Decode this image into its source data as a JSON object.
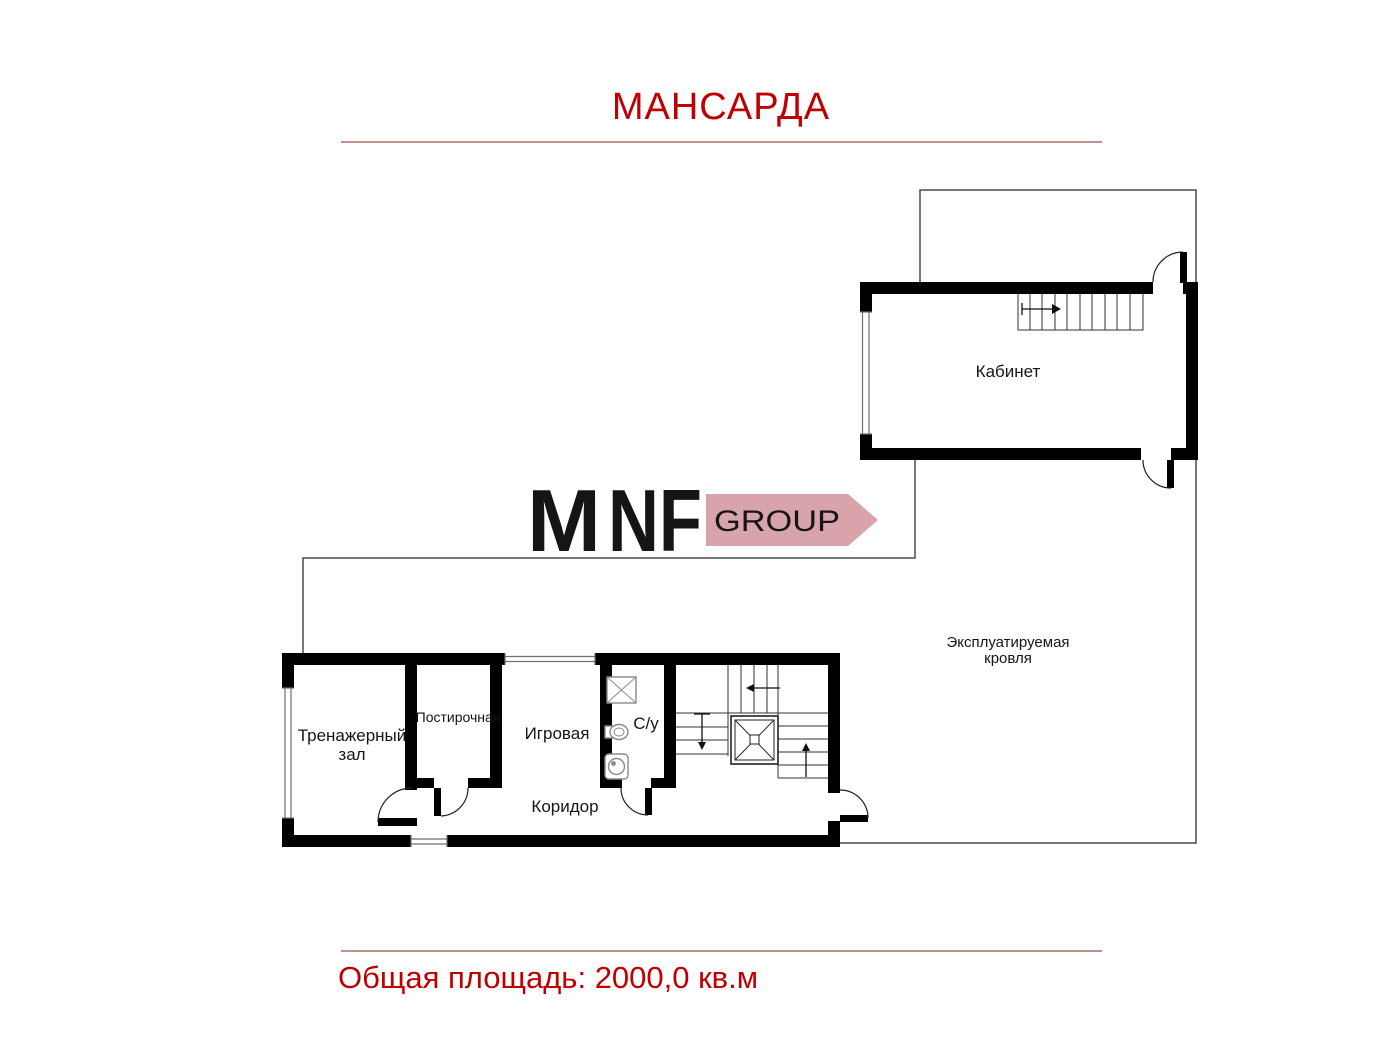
{
  "title": "МАНСАРДА",
  "footer": {
    "total_area": "Общая площадь: 2000,0 кв.м"
  },
  "logo": {
    "symbol": "М",
    "name": "NF",
    "suffix": "GROUP"
  },
  "labels": {
    "kabinet": "Кабинет",
    "roof_line1": "Эксплуатируемая",
    "roof_line2": "кровля",
    "gym_line1": "Тренажерный",
    "gym_line2": "зал",
    "laundry": "Постирочная",
    "playroom": "Игровая",
    "wc": "С/у",
    "corridor": "Коридор"
  },
  "colors": {
    "accent_red": "#c00000",
    "rule_pink": "#c48f8f",
    "logo_pink": "#d8a3aa",
    "wall": "#000000",
    "thin_line": "#4a4a4a"
  }
}
